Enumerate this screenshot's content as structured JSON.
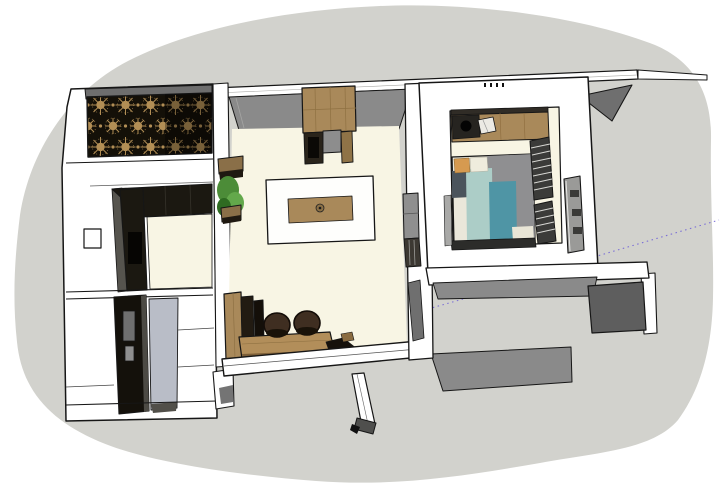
{
  "scene": {
    "description": "Top-down perspective 3D render of a small apartment model placed on a gray ground plane",
    "rooms": [
      {
        "id": "kitchen",
        "objects": [
          "decorative-screen",
          "l-shaped-black-counter",
          "wall-outlet",
          "kitchen-floor"
        ]
      },
      {
        "id": "entry-bath",
        "objects": [
          "tall-dark-cabinet",
          "cabinet-handle",
          "gray-floor-mat"
        ]
      },
      {
        "id": "living-dining",
        "objects": [
          "tall-wood-cabinet",
          "appliance-unit",
          "dining-table",
          "table-runner",
          "bowl",
          "wall-planter",
          "work-desk",
          "desk-chair",
          "desk-chair",
          "monitors"
        ]
      },
      {
        "id": "bedroom",
        "objects": [
          "vanity-counter",
          "sink-bowl",
          "vanity-chair",
          "bed",
          "pillows",
          "louvered-wardrobe",
          "door-panel"
        ]
      },
      {
        "id": "exterior",
        "objects": [
          "roof-band",
          "roof-shadow",
          "terrace-walls",
          "open-door-leaf",
          "guide-line",
          "guide-line"
        ]
      }
    ]
  },
  "palette": {
    "ground": "#d2d2cd",
    "wall_white": "#ffffff",
    "wall_face_gray": "#8a8a8a",
    "wall_face_dark": "#5e5e5e",
    "roof_shadow": "#6f6f6f",
    "floor_cream": "#f8f5e4",
    "entry_floor": "#b9bdc7",
    "wood": "#a9895a",
    "wood_desk": "#b28e5a",
    "counter_dark": "#1b1811",
    "cabinet_dark": "#14110b",
    "screen_bg": "#141008",
    "screen_accent": "#b28e55",
    "plant_green": "#4c8c38",
    "chair_brown": "#3f2e21",
    "guide_purple": "#7b6fd6",
    "bed_sheet": "#eae7da",
    "bed_duvet_gray": "#8f8f91",
    "bed_teal": "#4f95a5",
    "bed_light_teal": "#accdc7",
    "bed_slate": "#4b545c",
    "bed_orange": "#d69a50"
  }
}
